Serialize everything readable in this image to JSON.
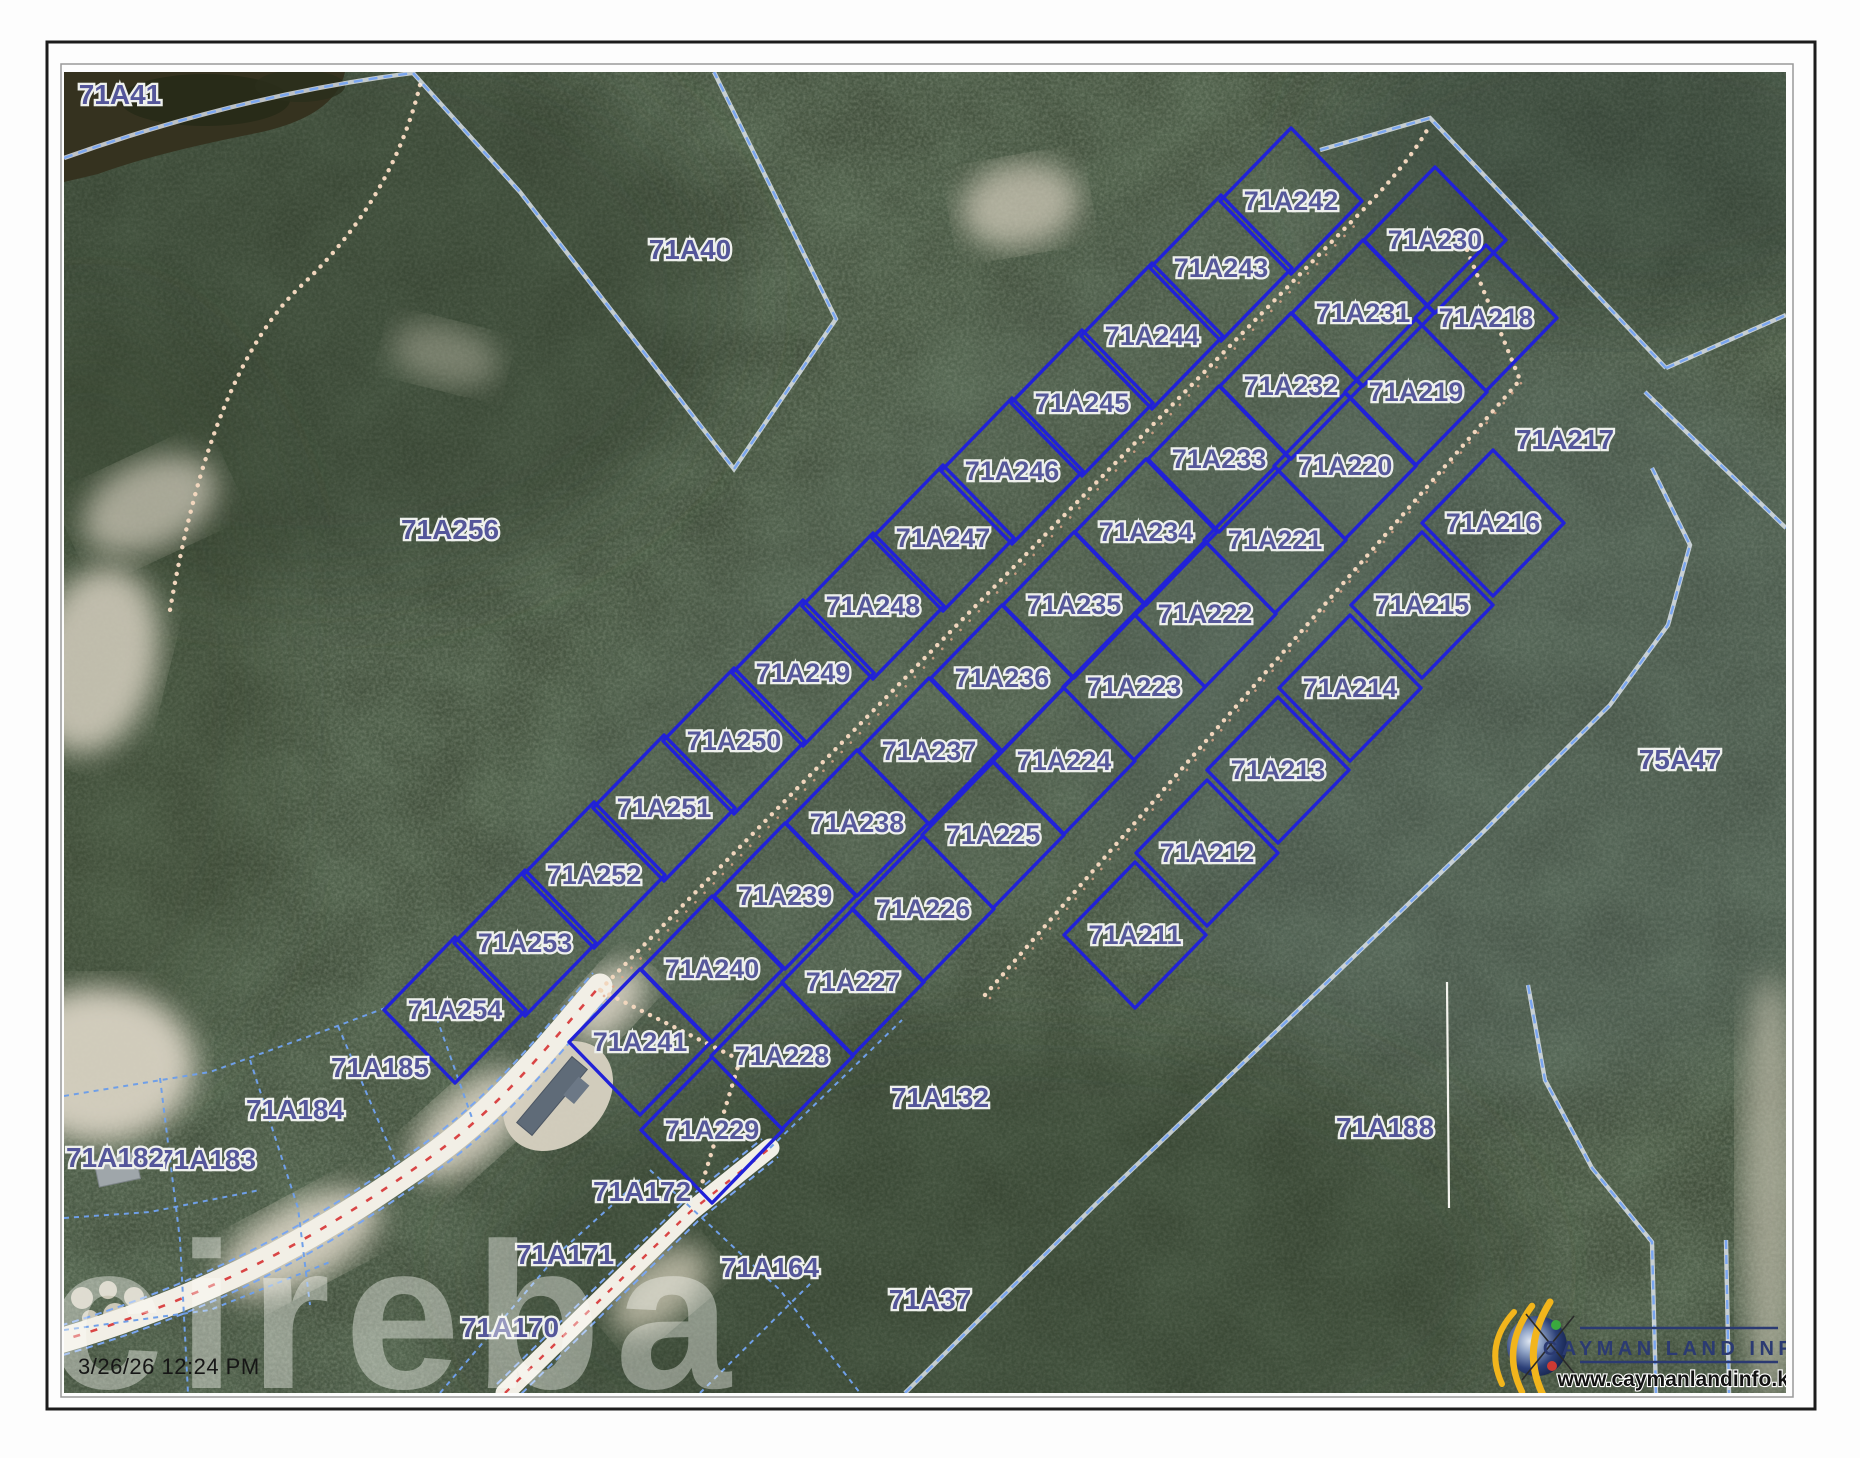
{
  "window": {
    "timestamp": "3/26/26 12:24 PM",
    "watermark": "cireba"
  },
  "branding": {
    "name": "CAYMAN LAND INFO",
    "website": "www.caymanlandinfo.ky"
  },
  "colors": {
    "parcel_line": "#2121d8",
    "boundary_dash": "#7aa6f0",
    "label_text": "#56589b",
    "road_centerline": "#d94545",
    "trail_dots": "#f1d6bd",
    "forest_base": "#44513e"
  },
  "map": {
    "parcel_labels": [
      {
        "id": "71A254",
        "x": 455,
        "y": 1010,
        "diamond": true
      },
      {
        "id": "71A253",
        "x": 525,
        "y": 943,
        "diamond": true
      },
      {
        "id": "71A252",
        "x": 594,
        "y": 875,
        "diamond": true
      },
      {
        "id": "71A251",
        "x": 664,
        "y": 808,
        "diamond": true
      },
      {
        "id": "71A250",
        "x": 734,
        "y": 741,
        "diamond": true
      },
      {
        "id": "71A249",
        "x": 803,
        "y": 673,
        "diamond": true
      },
      {
        "id": "71A248",
        "x": 873,
        "y": 606,
        "diamond": true
      },
      {
        "id": "71A247",
        "x": 943,
        "y": 538,
        "diamond": true
      },
      {
        "id": "71A246",
        "x": 1012,
        "y": 471,
        "diamond": true
      },
      {
        "id": "71A245",
        "x": 1082,
        "y": 403,
        "diamond": true
      },
      {
        "id": "71A244",
        "x": 1152,
        "y": 336,
        "diamond": true
      },
      {
        "id": "71A243",
        "x": 1221,
        "y": 268,
        "diamond": true
      },
      {
        "id": "71A242",
        "x": 1291,
        "y": 201,
        "diamond": true
      },
      {
        "id": "71A241",
        "x": 640,
        "y": 1042,
        "diamond": true
      },
      {
        "id": "71A240",
        "x": 712,
        "y": 969,
        "diamond": true
      },
      {
        "id": "71A239",
        "x": 785,
        "y": 896,
        "diamond": true
      },
      {
        "id": "71A238",
        "x": 857,
        "y": 823,
        "diamond": true
      },
      {
        "id": "71A237",
        "x": 929,
        "y": 751,
        "diamond": true
      },
      {
        "id": "71A236",
        "x": 1002,
        "y": 678,
        "diamond": true
      },
      {
        "id": "71A235",
        "x": 1074,
        "y": 605,
        "diamond": true
      },
      {
        "id": "71A234",
        "x": 1146,
        "y": 532,
        "diamond": true
      },
      {
        "id": "71A233",
        "x": 1219,
        "y": 459,
        "diamond": true
      },
      {
        "id": "71A232",
        "x": 1291,
        "y": 386,
        "diamond": true
      },
      {
        "id": "71A231",
        "x": 1363,
        "y": 313,
        "diamond": true
      },
      {
        "id": "71A230",
        "x": 1435,
        "y": 240,
        "diamond": true
      },
      {
        "id": "71A229",
        "x": 712,
        "y": 1130,
        "diamond": true
      },
      {
        "id": "71A228",
        "x": 782,
        "y": 1056,
        "diamond": true
      },
      {
        "id": "71A227",
        "x": 853,
        "y": 982,
        "diamond": true
      },
      {
        "id": "71A226",
        "x": 923,
        "y": 909,
        "diamond": true
      },
      {
        "id": "71A225",
        "x": 993,
        "y": 835,
        "diamond": true
      },
      {
        "id": "71A224",
        "x": 1064,
        "y": 761,
        "diamond": true
      },
      {
        "id": "71A223",
        "x": 1134,
        "y": 687,
        "diamond": true
      },
      {
        "id": "71A222",
        "x": 1205,
        "y": 614,
        "diamond": true
      },
      {
        "id": "71A221",
        "x": 1275,
        "y": 540,
        "diamond": true
      },
      {
        "id": "71A220",
        "x": 1345,
        "y": 466,
        "diamond": true
      },
      {
        "id": "71A219",
        "x": 1416,
        "y": 392,
        "diamond": true
      },
      {
        "id": "71A218",
        "x": 1486,
        "y": 318,
        "diamond": true
      },
      {
        "id": "71A211",
        "x": 1135,
        "y": 935,
        "diamond": true
      },
      {
        "id": "71A212",
        "x": 1207,
        "y": 853,
        "diamond": true
      },
      {
        "id": "71A213",
        "x": 1278,
        "y": 770,
        "diamond": true
      },
      {
        "id": "71A214",
        "x": 1350,
        "y": 688,
        "diamond": true
      },
      {
        "id": "71A215",
        "x": 1422,
        "y": 605,
        "diamond": true
      },
      {
        "id": "71A216",
        "x": 1493,
        "y": 523,
        "diamond": true
      },
      {
        "id": "71A217",
        "x": 1565,
        "y": 440,
        "diamond": false
      },
      {
        "id": "71A41",
        "x": 120,
        "y": 95,
        "diamond": false
      },
      {
        "id": "71A40",
        "x": 690,
        "y": 250,
        "diamond": false
      },
      {
        "id": "71A256",
        "x": 450,
        "y": 530,
        "diamond": false
      },
      {
        "id": "75A47",
        "x": 1680,
        "y": 760,
        "diamond": false
      },
      {
        "id": "71A188",
        "x": 1385,
        "y": 1128,
        "diamond": false
      },
      {
        "id": "71A132",
        "x": 940,
        "y": 1098,
        "diamond": false
      },
      {
        "id": "71A37",
        "x": 930,
        "y": 1300,
        "diamond": false
      },
      {
        "id": "71A164",
        "x": 770,
        "y": 1268,
        "diamond": false
      },
      {
        "id": "71A172",
        "x": 642,
        "y": 1192,
        "diamond": false
      },
      {
        "id": "71A171",
        "x": 565,
        "y": 1255,
        "diamond": false
      },
      {
        "id": "71A170",
        "x": 510,
        "y": 1328,
        "diamond": false
      },
      {
        "id": "71A185",
        "x": 380,
        "y": 1068,
        "diamond": false
      },
      {
        "id": "71A184",
        "x": 295,
        "y": 1110,
        "diamond": false
      },
      {
        "id": "71A183",
        "x": 207,
        "y": 1160,
        "diamond": false
      },
      {
        "id": "71A182",
        "x": 115,
        "y": 1158,
        "diamond": false
      }
    ]
  }
}
